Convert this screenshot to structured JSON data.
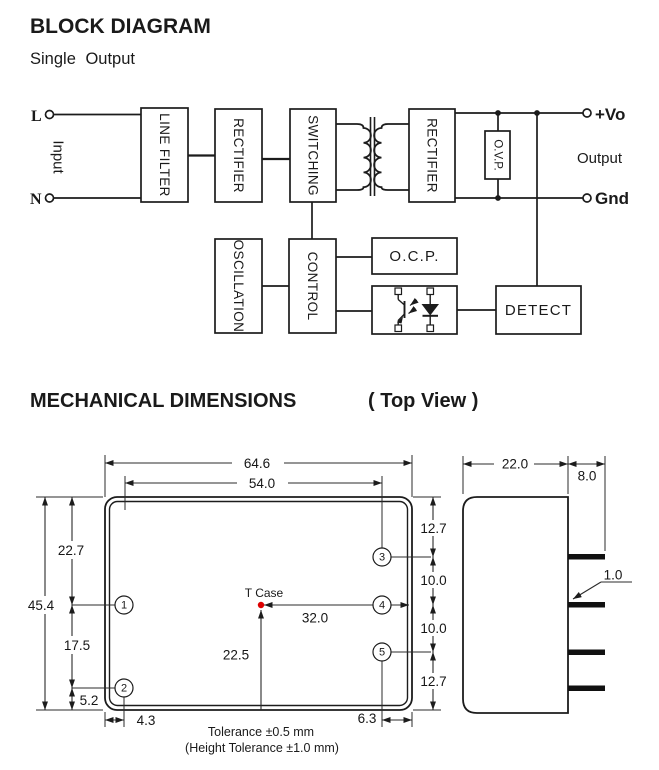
{
  "block_diagram": {
    "title": "BLOCK DIAGRAM",
    "subtitle": "Single Output",
    "input": {
      "l": "L",
      "n": "N",
      "label": "Input"
    },
    "blocks": {
      "line_filter": "LINE FILTER",
      "rectifier1": "RECTIFIER",
      "switching": "SWITCHING",
      "rectifier2": "RECTIFIER",
      "ovp": "O.V.P.",
      "oscillation": "OSCILLATION",
      "control": "CONTROL",
      "ocp": "O.C.P.",
      "detect": "DETECT"
    },
    "output": {
      "vo": "+Vo",
      "label": "Output",
      "gnd": "Gnd"
    }
  },
  "mechanical": {
    "title": "MECHANICAL DIMENSIONS",
    "view_label": "( Top View )",
    "t_case_label": "T Case",
    "dims": {
      "outer_width": "64.6",
      "inner_width": "54.0",
      "total_height": "45.4",
      "top_to_pin1": "22.7",
      "pin1_to_pin2": "17.5",
      "pin2_to_bottom": "5.2",
      "left_pin_offset": "4.3",
      "right_pin_offset": "6.3",
      "top_to_pin3": "12.7",
      "pin3_to_pin4": "10.0",
      "pin4_to_pin5": "10.0",
      "pin5_to_bottom": "12.7",
      "tcase_to_right_edge": "32.0",
      "tcase_to_bottom": "22.5",
      "case_depth": "22.0",
      "pin_length": "8.0",
      "pin_thickness": "1.0"
    },
    "pins": [
      "1",
      "2",
      "3",
      "4",
      "5"
    ],
    "notes": {
      "tolerance": "Tolerance ±0.5 mm",
      "height_tolerance": "(Height Tolerance ±1.0 mm)"
    },
    "colors": {
      "line": "#1c1c1c",
      "tcase_dot": "#dd0000"
    }
  }
}
